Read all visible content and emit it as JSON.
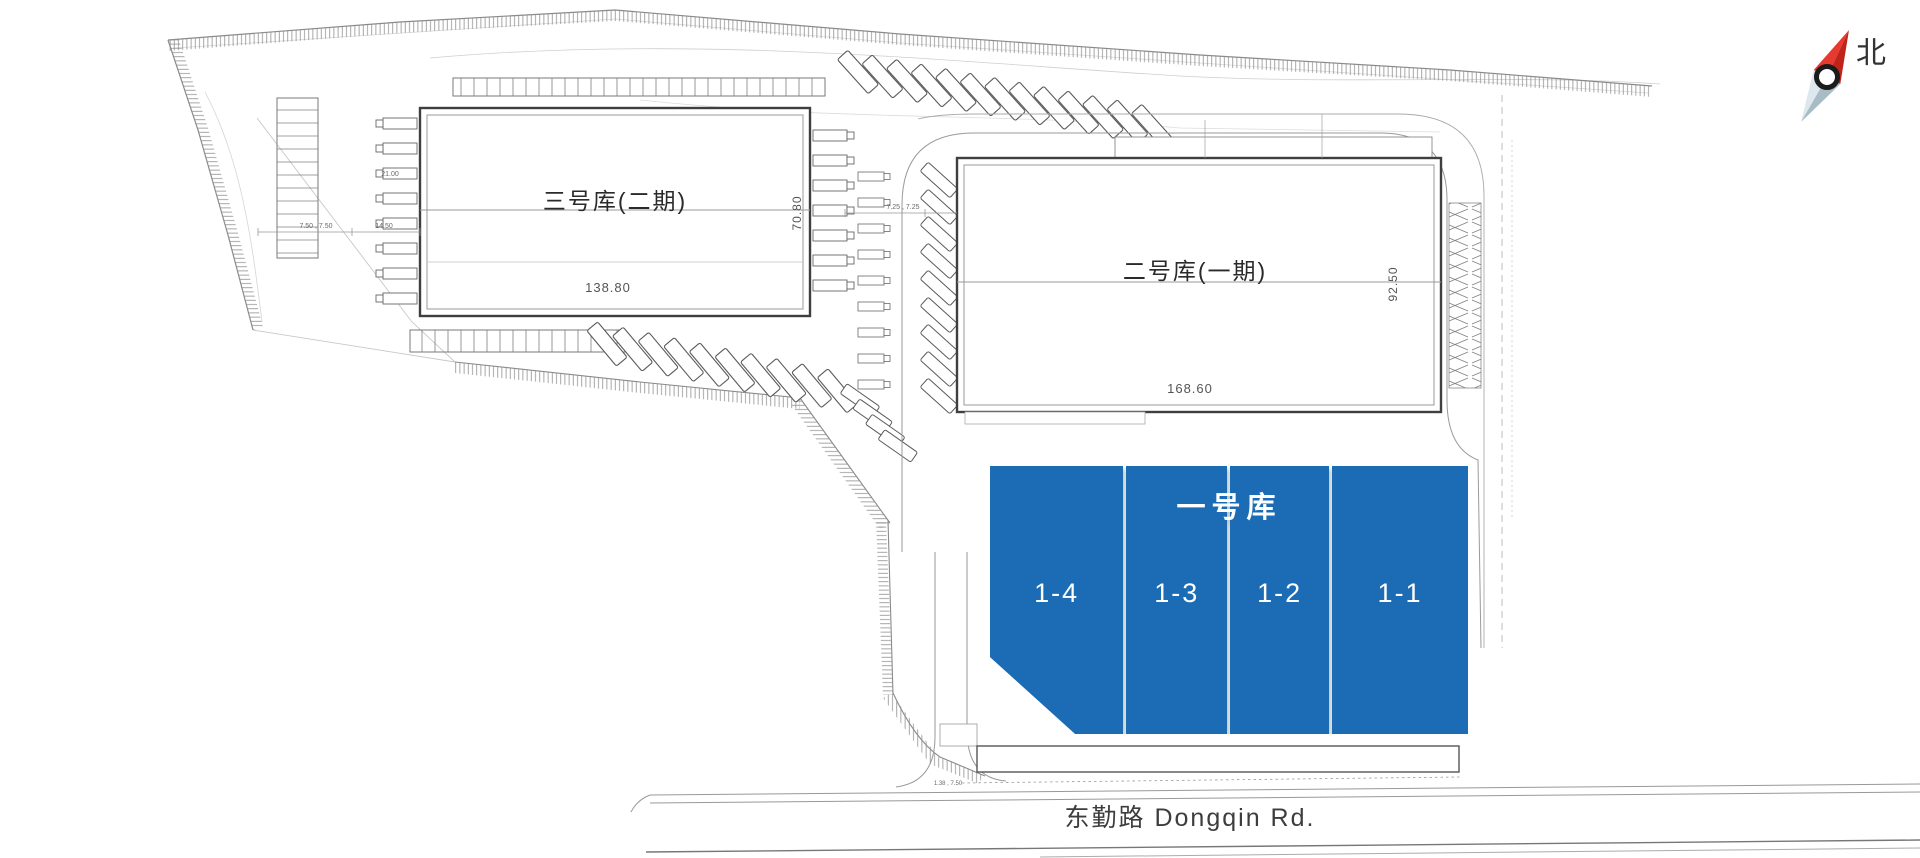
{
  "plan": {
    "compass": {
      "north_label": "北"
    },
    "road": {
      "name": "东勤路 Dongqin Rd."
    },
    "buildings": {
      "warehouse_3": {
        "name": "三号库(二期)",
        "width_m": "138.80",
        "depth_m": "70.80"
      },
      "warehouse_2": {
        "name": "二号库(一期)",
        "width_m": "168.60",
        "depth_m": "92.50"
      },
      "warehouse_1": {
        "name": "一号库",
        "highlight_color": "#1b6cb4",
        "units": [
          {
            "id": "1-4"
          },
          {
            "id": "1-3"
          },
          {
            "id": "1-2"
          },
          {
            "id": "1-1"
          }
        ]
      }
    },
    "dimension_labels": {
      "left_gap_a": "21.00",
      "left_gap_b": "7.50 , 7.50",
      "left_gap_c": "14.50",
      "mid_gap": "7.25 , 7.25",
      "south_gap": "1.38 , 7.50"
    },
    "colors": {
      "compass_red": "#d93025",
      "linework": "#3f3f3f"
    }
  }
}
